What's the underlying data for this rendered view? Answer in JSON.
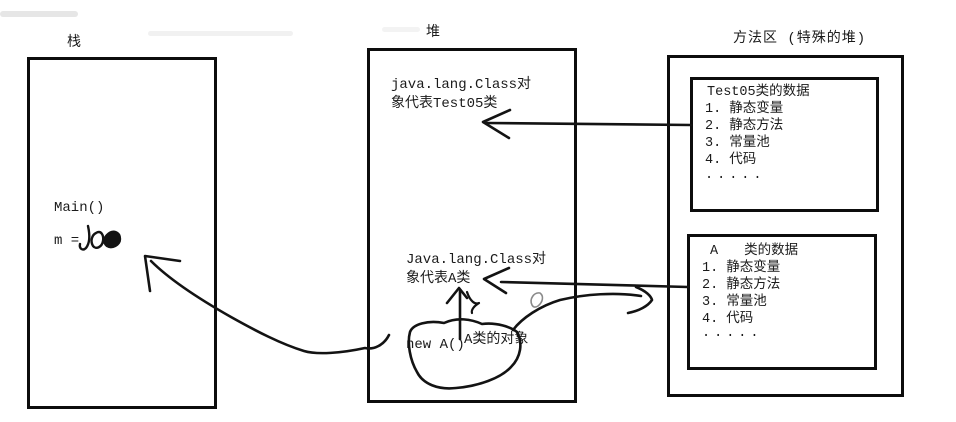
{
  "colors": {
    "background": "#ffffff",
    "ink": "#131313",
    "box_border": "#0d0d0d",
    "faint_smudge": "#e9e9e9"
  },
  "stack": {
    "label": "栈",
    "frame_label": "Main()",
    "variable_label": "m ="
  },
  "heap": {
    "label": "堆",
    "test05_class_object": {
      "line1": "java.lang.Class对",
      "line2": "象代表Test05类"
    },
    "a_class_object": {
      "line1": "Java.lang.Class对",
      "line2": "象代表A类"
    },
    "new_expression": "new A()",
    "object_label": "A类的对象"
  },
  "method_area": {
    "label": "方法区 (特殊的堆)",
    "test05_data": {
      "title": "Test05类的数据",
      "items": [
        "1. 静态变量",
        "2. 静态方法",
        "3. 常量池",
        "4. 代码",
        "....."
      ]
    },
    "a_data": {
      "title_prefix": "A",
      "title_suffix": "类的数据",
      "items": [
        "1. 静态变量",
        "2. 静态方法",
        "3. 常量池",
        "4. 代码",
        "....."
      ]
    }
  }
}
